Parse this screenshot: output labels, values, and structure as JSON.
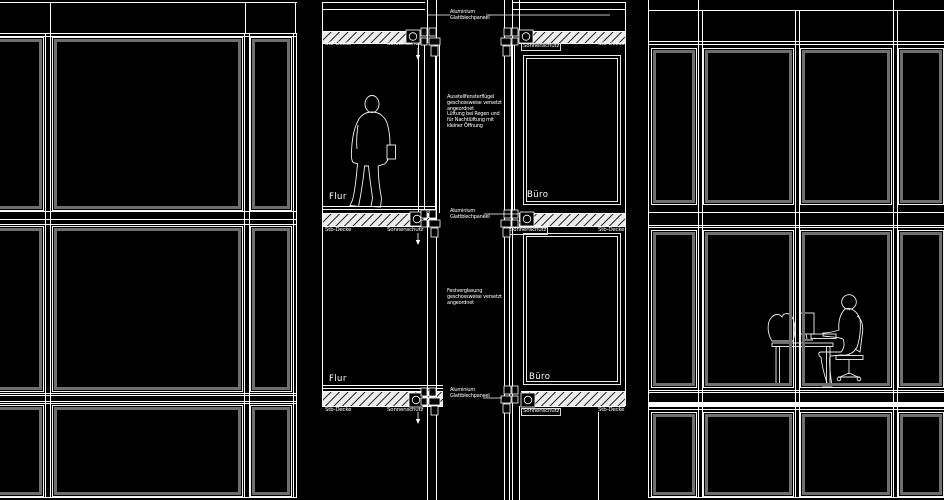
{
  "drawing": {
    "labels": {
      "flur": "Flur",
      "buero": "Büro",
      "stb_decke": "Stb-Decke",
      "sonnenschutz": "Sonnenschutz",
      "alu_panel": [
        "Aluminium",
        "Glattblechpaneel"
      ]
    },
    "annotations": {
      "ausstellfenster": [
        "Ausstellfensterflügel",
        "geschossweise versetzt",
        "angeordnet",
        "Lüftung bei Regen und",
        "für Nachtlüftung mit",
        "kleiner Öffnung"
      ],
      "festverglasung": [
        "Festverglasung",
        "geschossweise versetzt",
        "angeordnet"
      ]
    },
    "colors": {
      "background": "#000000",
      "line": "#ffffff",
      "frame_gray": "#6f6f6f",
      "slab_fill": "#ececec",
      "figure_line": "#f0f0f0"
    }
  }
}
